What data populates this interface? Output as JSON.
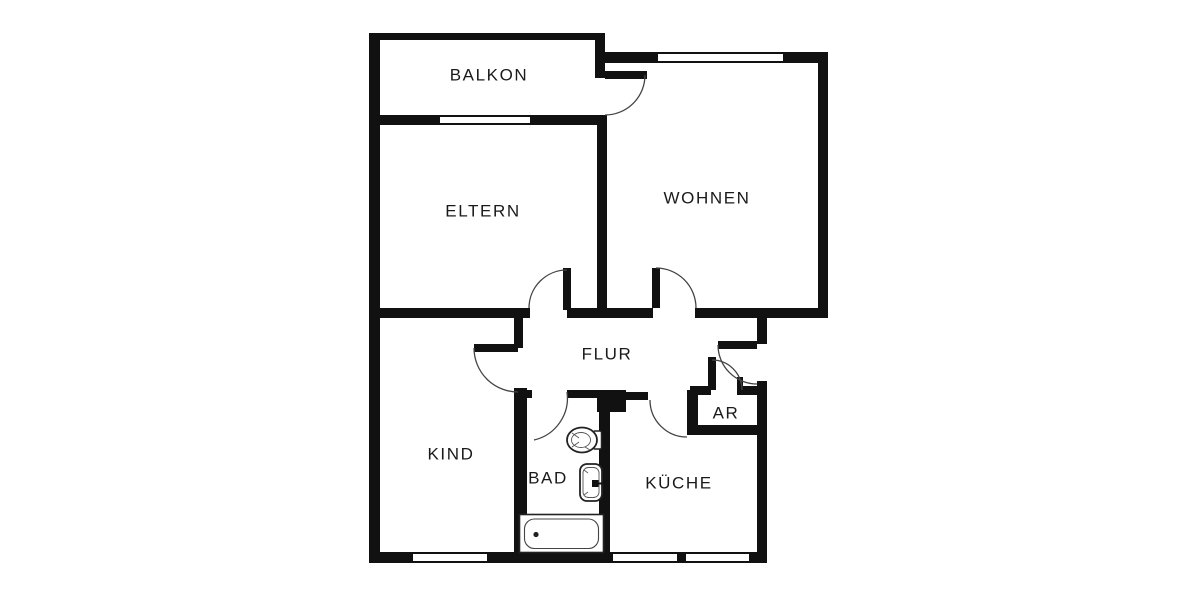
{
  "floorplan": {
    "colors": {
      "wall": "#111111",
      "door_arc": "#444444",
      "text": "#1a1a1a",
      "background": "#ffffff"
    },
    "rooms": [
      {
        "id": "balkon",
        "label": "BALKON"
      },
      {
        "id": "eltern",
        "label": "ELTERN"
      },
      {
        "id": "wohnen",
        "label": "WOHNEN"
      },
      {
        "id": "flur",
        "label": "FLUR"
      },
      {
        "id": "kind",
        "label": "KIND"
      },
      {
        "id": "bad",
        "label": "BAD"
      },
      {
        "id": "kueche",
        "label": "KÜCHE"
      },
      {
        "id": "ar",
        "label": "AR"
      }
    ],
    "fixtures": [
      {
        "name": "bathtub"
      },
      {
        "name": "toilet"
      },
      {
        "name": "sink"
      }
    ]
  }
}
